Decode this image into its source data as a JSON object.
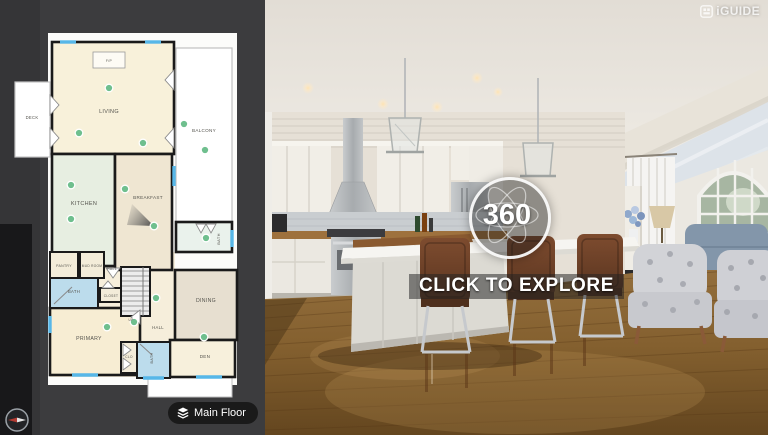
{
  "brand": {
    "logo": "iGUIDE"
  },
  "viewer": {
    "badge": "360",
    "cta": "CLICK TO EXPLORE"
  },
  "controls": {
    "floor_selector": "Main Floor"
  },
  "floorplan": {
    "hotspot_color": "#6fbf8e",
    "window_color": "#57b7e8",
    "labels": {
      "living": "LIVING",
      "balcony": "BALCONY",
      "deck": "DECK",
      "kitchen": "KITCHEN",
      "breakfast": "BREAKFAST",
      "dining": "DINING",
      "den": "DEN",
      "primary": "PRIMARY",
      "pantry": "PANTRY",
      "mud_room": "MUD ROOM",
      "hall_upper": "HALL",
      "hall_lower": "HALL",
      "bath_left": "BATH",
      "bath_upper": "BATH",
      "bath_lower": "BATH",
      "closet": "CLOSET",
      "clo": "CLO",
      "fireplace": "F/P",
      "up": "UP"
    }
  }
}
